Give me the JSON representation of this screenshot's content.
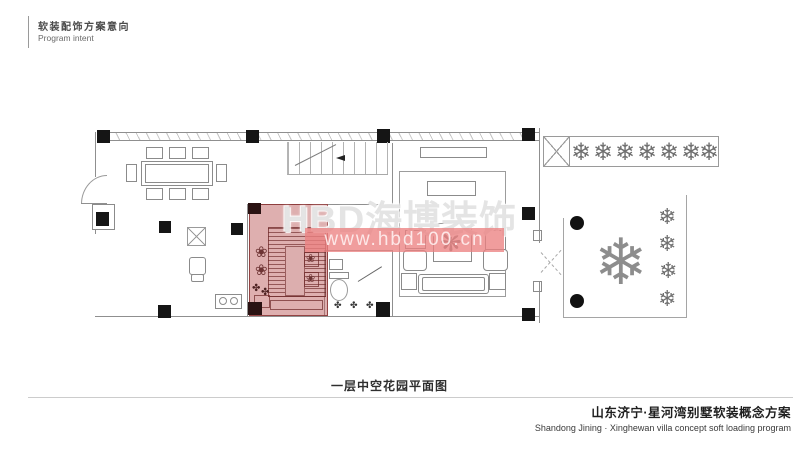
{
  "page": {
    "header": {
      "title_cn": "软装配饰方案意向",
      "title_en": "Program intent"
    },
    "watermark": {
      "brand": "HBD海博装饰",
      "url": "www.hbd100.cn"
    },
    "caption": "一层中空花园平面图",
    "footer": {
      "project_cn": "山东济宁·星河湾别墅软装概念方案",
      "project_en": "Shandong Jining · Xinghewan villa concept soft loading program"
    },
    "icons": {
      "tree": "❄",
      "big_tree": "❄",
      "plant": "❀",
      "shrub": "✤",
      "table_plant": "❋"
    },
    "colors": {
      "highlight_fill": "#be5f5f",
      "highlight_line": "#7c3b3b",
      "watermark_bar": "#ec8282",
      "wall_line": "#8f8f8f",
      "column": "#151515"
    }
  }
}
